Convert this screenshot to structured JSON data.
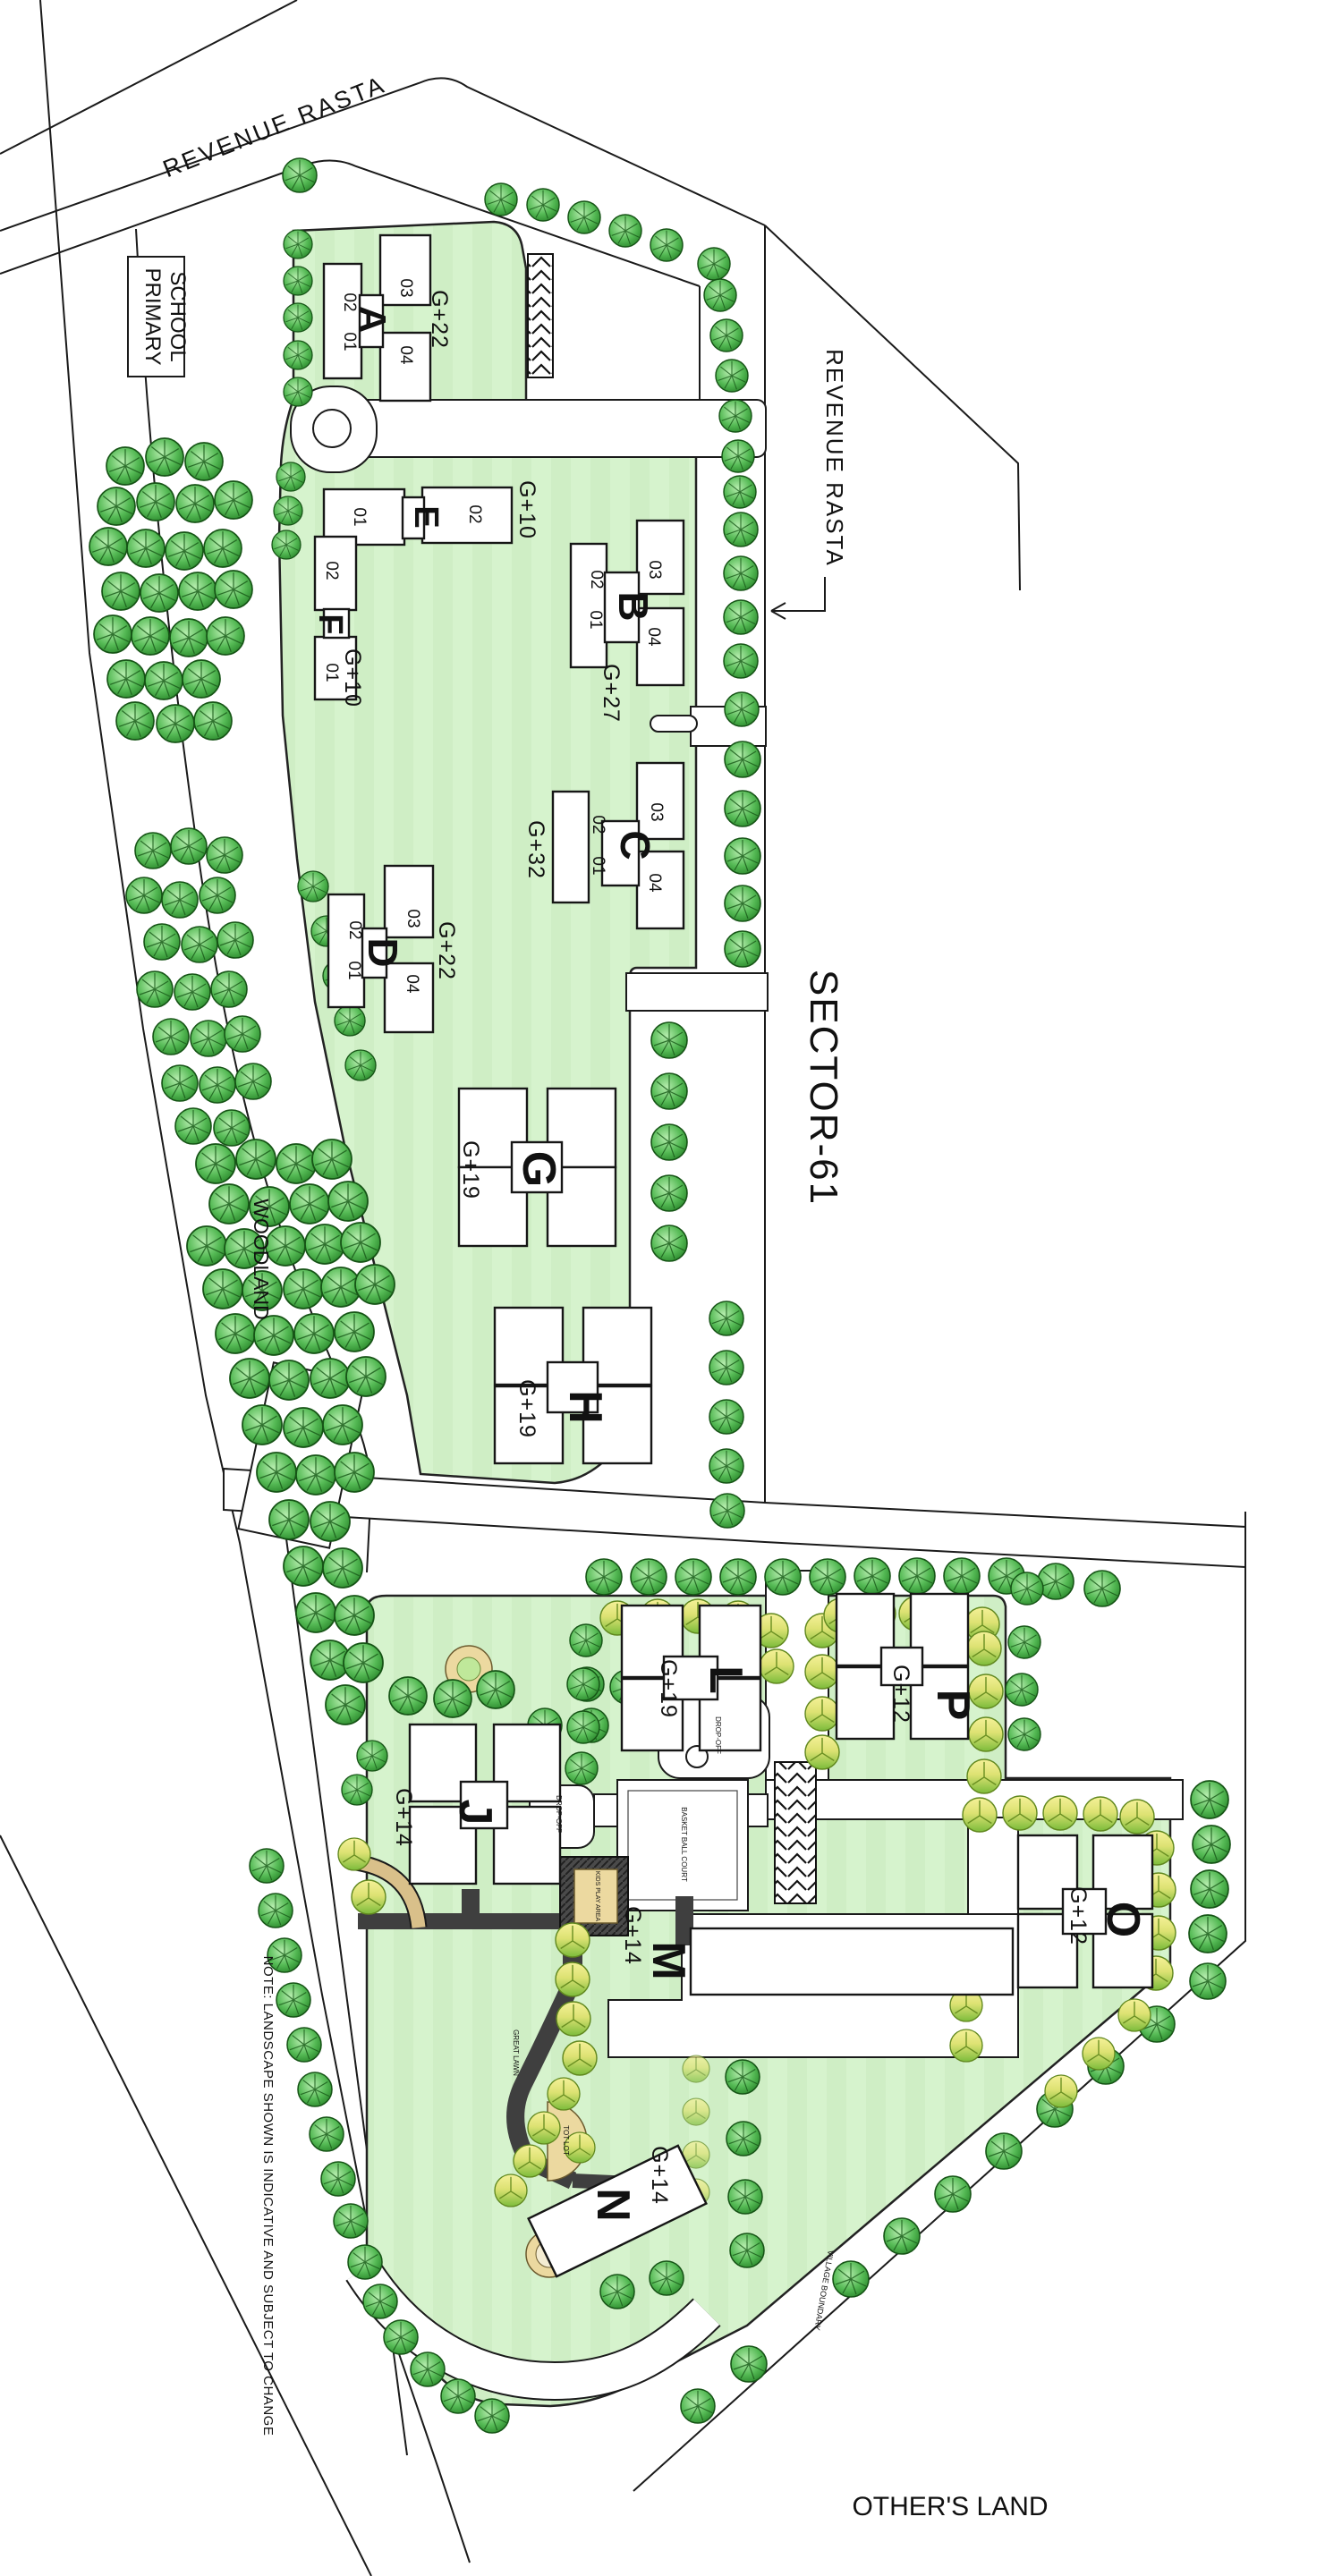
{
  "plan": {
    "sector_label": "SECTOR-61",
    "revenue_rasta_top": "REVENUE  RASTA",
    "revenue_rasta_right": "REVENUE  RASTA",
    "primary_school_line1": "PRIMARY",
    "primary_school_line2": "SCHOOL",
    "woodland": "WOODLAND",
    "others_land": "OTHER'S LAND",
    "village_boundary": "VILLAGE BOUNDARY",
    "note": "NOTE: LANDSCAPE SHOWN IS INDICATIVE AND SUBJECT TO CHANGE",
    "great_lawn": "GREAT LAWN",
    "tot_lot": "TOT LOT",
    "kids_play_area": "KIDS PLAY AREA",
    "basketball_court": "BASKET BALL COURT",
    "drop_off_l": "DROP-OFF",
    "drop_off_j": "DROP-OFF"
  },
  "buildings": [
    {
      "letter": "A",
      "floors": "G+22",
      "units": [
        "01",
        "02",
        "03",
        "04"
      ]
    },
    {
      "letter": "B",
      "floors": "G+27",
      "units": [
        "01",
        "02",
        "03",
        "04"
      ]
    },
    {
      "letter": "C",
      "floors": "G+32",
      "units": [
        "01",
        "02",
        "03",
        "04"
      ]
    },
    {
      "letter": "D",
      "floors": "G+22",
      "units": [
        "01",
        "02",
        "03",
        "04"
      ]
    },
    {
      "letter": "E",
      "floors": "G+10",
      "units": [
        "01",
        "02"
      ]
    },
    {
      "letter": "F",
      "floors": "G+10",
      "units": [
        "01",
        "02"
      ]
    },
    {
      "letter": "G",
      "floors": "G+19",
      "units": []
    },
    {
      "letter": "H",
      "floors": "G+19",
      "units": []
    },
    {
      "letter": "J",
      "floors": "G+14",
      "units": []
    },
    {
      "letter": "L",
      "floors": "G+19",
      "units": []
    },
    {
      "letter": "M",
      "floors": "G+14",
      "units": []
    },
    {
      "letter": "N",
      "floors": "G+14",
      "units": []
    },
    {
      "letter": "O",
      "floors": "G+12",
      "units": []
    },
    {
      "letter": "P",
      "floors": "G+12",
      "units": []
    }
  ],
  "colors": {
    "lawn": "#d6f3cd",
    "tree_dark": "#2f8f2f",
    "tree_yellow": "#e9e782",
    "sand": "#ecd9a0",
    "path_dark": "#3f3f3f"
  }
}
